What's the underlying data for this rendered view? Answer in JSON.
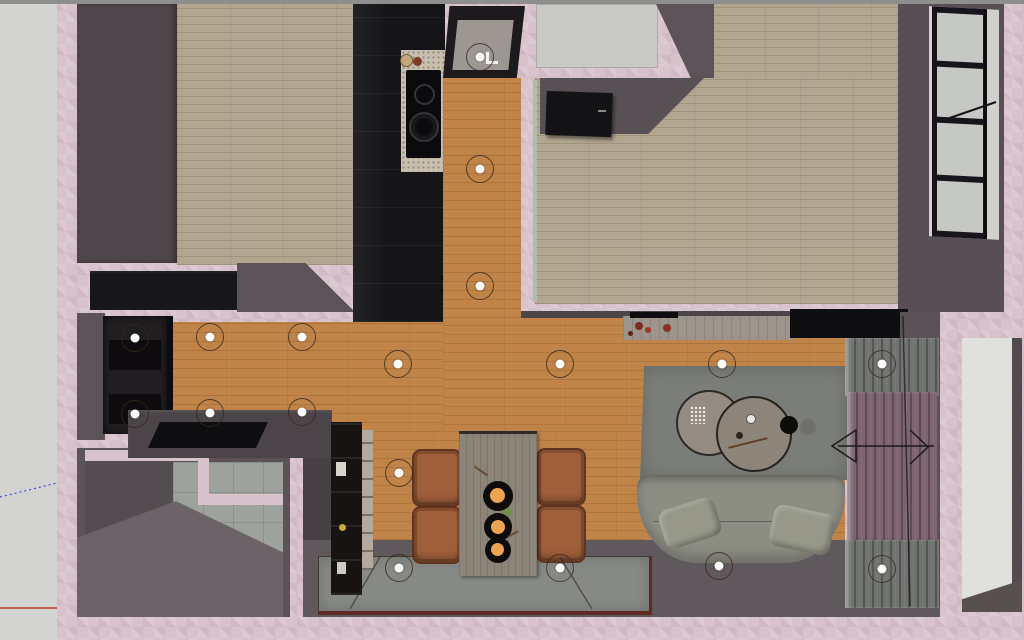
{
  "view": {
    "label": "3d-floor-plan-top-view",
    "style": "sketchup-viewport-render",
    "visible_text": "none"
  },
  "colors": {
    "pink-wall": "#d8c3cd",
    "outside-gray": "#d3d3d1",
    "top-strip": "#8e8e8c",
    "dark-wall": "#5b5357",
    "dark-wall-2": "#4b4448",
    "dark-wall-3": "#464044",
    "bedroom1-block": "#4d464a",
    "parquet": "#b2a690",
    "orange-floor": "#c08449",
    "tile": "#9da29d",
    "cabinet-black": "#151518",
    "counter": "#c9bfb0",
    "cooktop": "#0b0b0d",
    "closet-gray": "#c9c9c5",
    "glass": "#c6c8c4",
    "window-frame": "#17141b",
    "wardrobe": "#211e21",
    "console-black": "#17171a",
    "deck": "#4b4549",
    "slab-black": "#0e0e10",
    "bookshelf": "#171310",
    "shelf-interior": "#b3aa9d",
    "table": "#8b8478",
    "chair": "#a15f3b",
    "fruit": "#eda34f",
    "rug": "#7b7d78",
    "coffee-table": "#948c82",
    "coffee-table-2": "#8d8579",
    "sofa": "#8c8d83",
    "pillow": "#979889",
    "sideboard": "#9b958b",
    "tv-black": "#0e0e10",
    "curtain-gray": "#70736f",
    "curtain-mauve": "#7e6471",
    "entry-floor": "#5f585c",
    "mat": "#868986",
    "mat-border": "#5d2b22",
    "door-white": "#e0e1dc",
    "green-track": "#aebfa8",
    "axis-red": "#c23b2a",
    "axis-blue": "#3a4fd0",
    "light-dot": "#ffffff",
    "light-ring": "#3f3428"
  },
  "lights": {
    "ring_diameter_px": 26,
    "dot_diameter_px": 9,
    "positions": [
      [
        479,
        56
      ],
      [
        479,
        168
      ],
      [
        479,
        285
      ],
      [
        134,
        337
      ],
      [
        209,
        336
      ],
      [
        301,
        336
      ],
      [
        134,
        413
      ],
      [
        209,
        412
      ],
      [
        301,
        411
      ],
      [
        397,
        363
      ],
      [
        398,
        472
      ],
      [
        398,
        567
      ],
      [
        559,
        363
      ],
      [
        721,
        363
      ],
      [
        881,
        363
      ],
      [
        559,
        567
      ],
      [
        718,
        565
      ],
      [
        881,
        568
      ]
    ]
  },
  "rooms": [
    {
      "name": "bedroom-top-left",
      "floor": "light-parquet"
    },
    {
      "name": "bedroom-top-right",
      "floor": "light-parquet"
    },
    {
      "name": "kitchen-corridor",
      "floor": "orange-wood"
    },
    {
      "name": "hallway",
      "floor": "orange-wood"
    },
    {
      "name": "wc-toilet",
      "floor": "gray"
    },
    {
      "name": "bathroom",
      "floor": "gray-tile"
    },
    {
      "name": "dining-area",
      "floor": "orange-wood"
    },
    {
      "name": "living-room",
      "floor": "orange-wood"
    },
    {
      "name": "entry",
      "floor": "dark-tile-with-mat"
    }
  ],
  "furniture": [
    "wardrobe-dark-block",
    "kitchen-cabinet-run",
    "cooktop",
    "kitchen-counter",
    "hallway-wardrobe",
    "black-console",
    "counter-deck",
    "bookshelf",
    "dining-table",
    "dining-chairs-x4",
    "fruit-bowls-x3",
    "sideboard",
    "tv",
    "area-rug",
    "round-coffee-tables-x2",
    "sofa-with-pillows",
    "curtains",
    "window-4-pane",
    "white-door-panel",
    "entry-mats",
    "ceiling-spotlights-x18",
    "open-door-top-right"
  ],
  "annotations": [
    "red-axis-line",
    "blue-dotted-axis-line",
    "door-swing-arrows"
  ]
}
